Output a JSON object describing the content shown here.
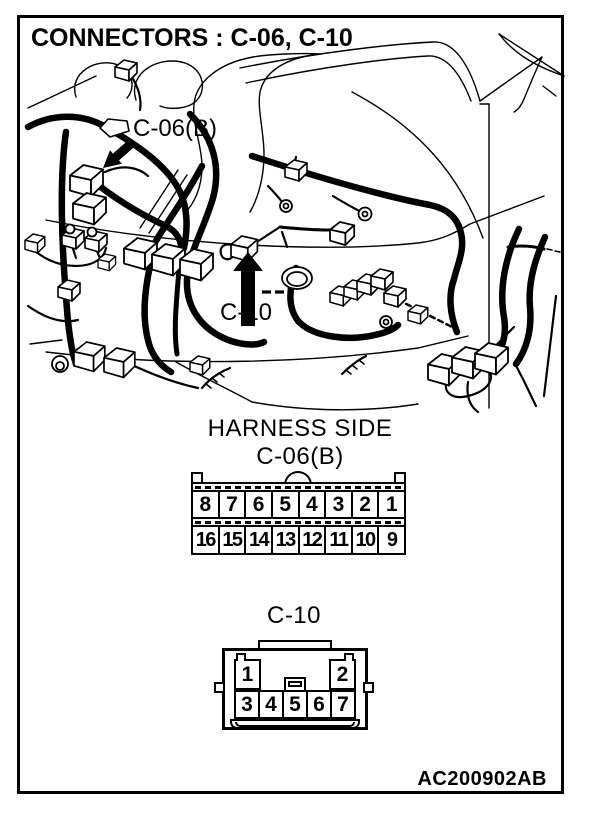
{
  "page": {
    "title": "CONNECTORS : C-06, C-10",
    "figure_code": "AC200902AB"
  },
  "diagram": {
    "callouts": [
      {
        "label": "C-06(B)"
      },
      {
        "label": "C-10"
      }
    ]
  },
  "harness_side": {
    "heading": "HARNESS SIDE",
    "connector_c06": {
      "label": "C-06(B)",
      "pin_rows": [
        [
          "8",
          "7",
          "6",
          "5",
          "4",
          "3",
          "2",
          "1"
        ],
        [
          "16",
          "15",
          "14",
          "13",
          "12",
          "11",
          "10",
          "9"
        ]
      ]
    },
    "connector_c10": {
      "label": "C-10",
      "top_pins": [
        "1",
        "2"
      ],
      "bottom_pins": [
        "3",
        "4",
        "5",
        "6",
        "7"
      ]
    }
  },
  "colors": {
    "ink": "#000000",
    "paper": "#ffffff"
  }
}
